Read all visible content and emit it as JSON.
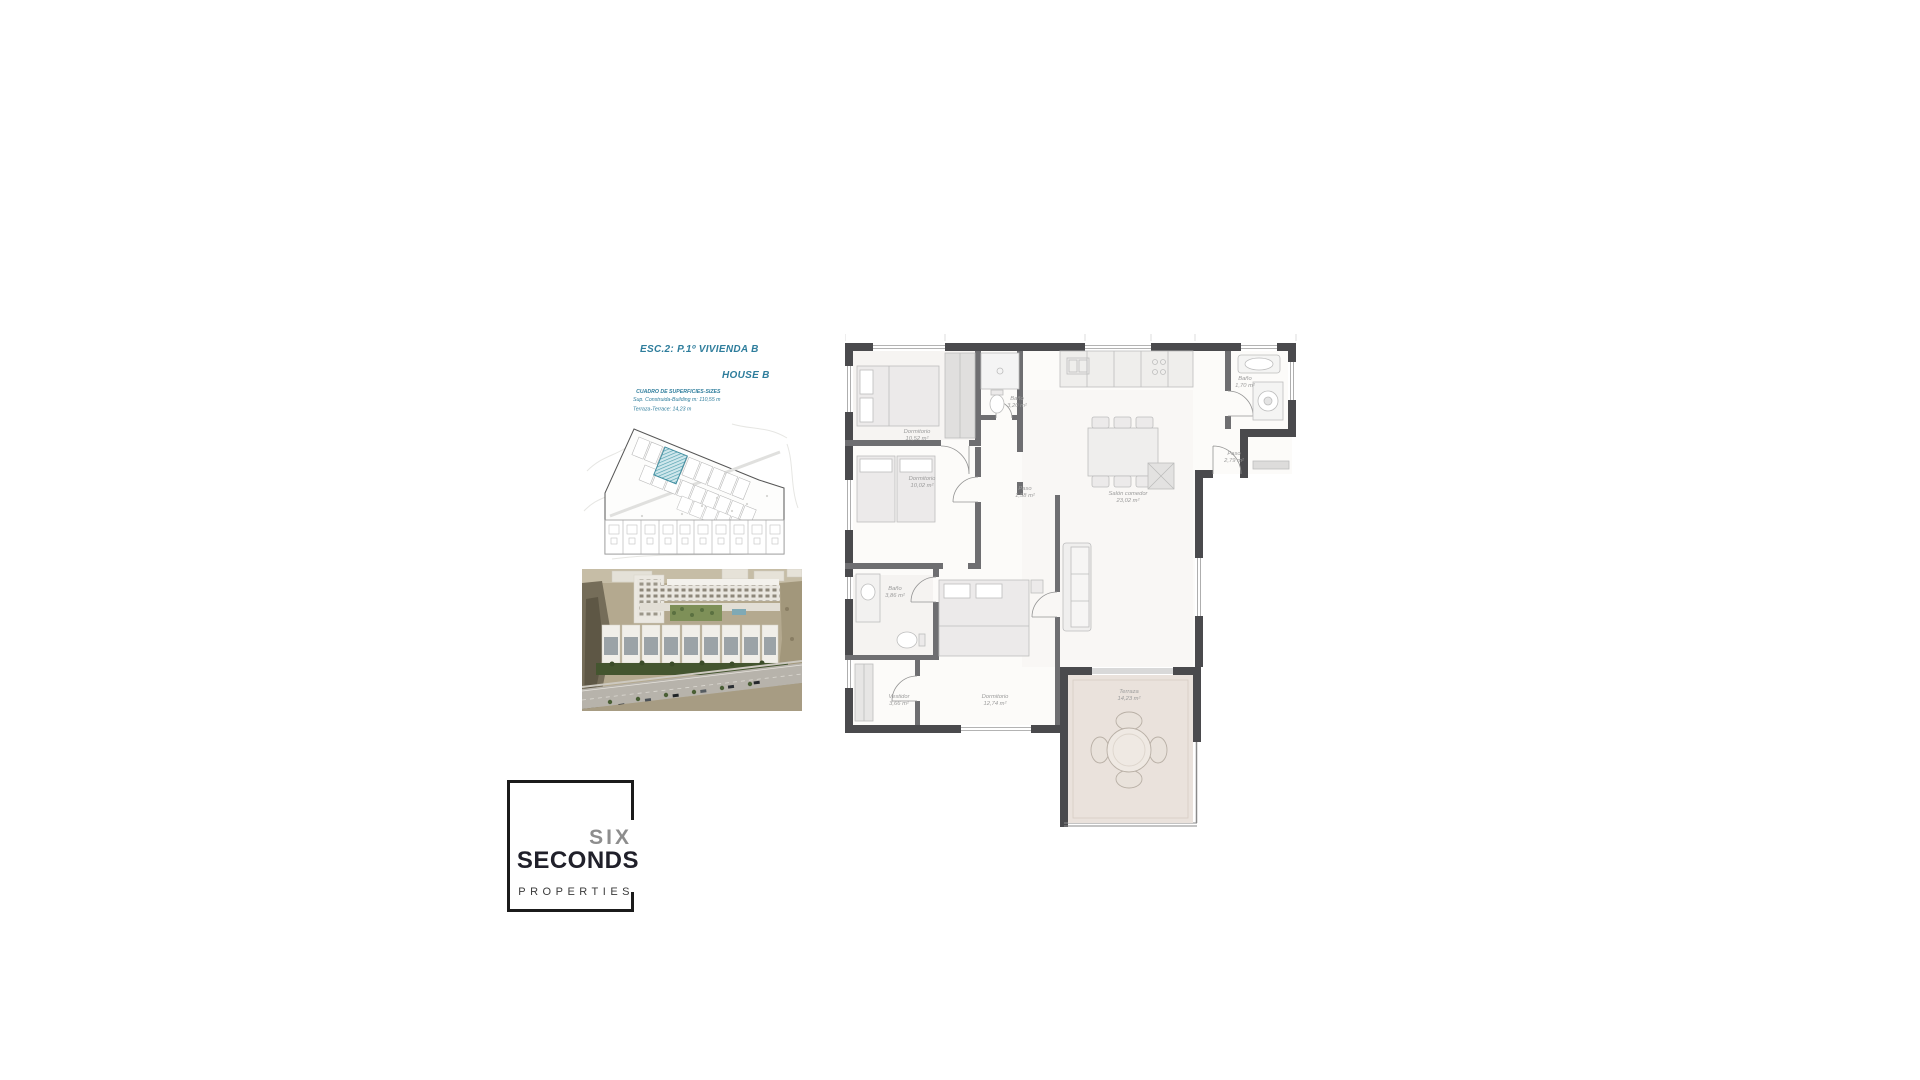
{
  "document": {
    "plan_title": "ESC.2: P.1º VIVIENDA B",
    "house_label": "HOUSE B",
    "surface_table": {
      "title": "CUADRO DE SUPERFICIES-SIZES",
      "built": "Sup. Construida-Building m: 110,55 m",
      "terrace": "Terraza-Terrace: 14,23 m"
    }
  },
  "floorplan": {
    "rooms": [
      {
        "name": "Dormitorio",
        "area": "10,52 m²"
      },
      {
        "name": "Baño",
        "area": "3,20 m²"
      },
      {
        "name": "Dormitorio",
        "area": "10,02 m²"
      },
      {
        "name": "Paso",
        "area": "1,58 m²"
      },
      {
        "name": "Salón comedor",
        "area": "23,02 m²"
      },
      {
        "name": "Baño",
        "area": "1,70 m²"
      },
      {
        "name": "Paso",
        "area": "2,79 m²"
      },
      {
        "name": "Baño",
        "area": "3,86 m²"
      },
      {
        "name": "Vestidor",
        "area": "3,66 m²"
      },
      {
        "name": "Dormitorio",
        "area": "12,74 m²"
      },
      {
        "name": "Terraza",
        "area": "14,23 m²"
      }
    ]
  },
  "logo": {
    "brand_top": "SIX",
    "brand_bottom": "SECONDS",
    "subtitle": "PROPERTIES"
  },
  "colors": {
    "accent": "#2e7d9c",
    "wall": "#4a4a4d",
    "label": "#9b9b9b",
    "terrace_fill": "#eae2dc",
    "highlight": "#4f9fae"
  }
}
